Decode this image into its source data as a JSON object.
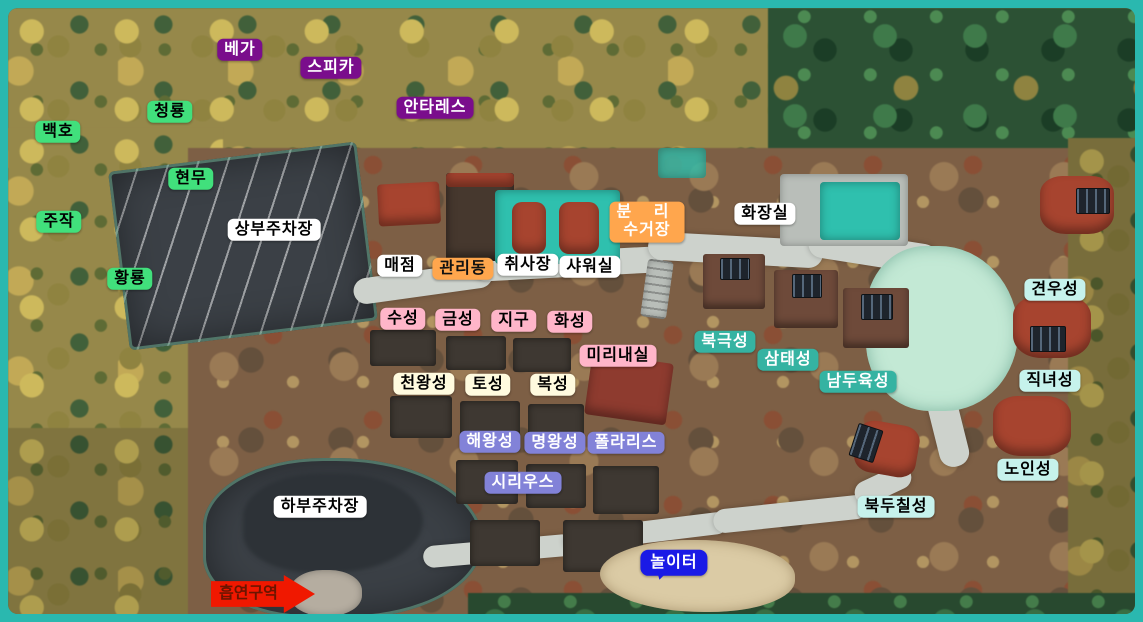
{
  "map_title": "campground aerial site map",
  "frame": {
    "border_color": "#2ab8af",
    "inner_line_color": "#0d837b"
  },
  "variants": {
    "purple": {
      "bg": "#7a0d8c",
      "fg": "#ffffff"
    },
    "green": {
      "bg": "#41e07c",
      "fg": "#000000"
    },
    "white": {
      "bg": "#ffffff",
      "fg": "#000000"
    },
    "orange-dark": {
      "bg": "#ffa64d",
      "fg": "#111111"
    },
    "orange-light": {
      "bg": "#ffa64d",
      "fg": "#ffffff"
    },
    "pink": {
      "bg": "#ffb5c9",
      "fg": "#000000"
    },
    "cream": {
      "bg": "#fffbdf",
      "fg": "#000000"
    },
    "periwinkle": {
      "bg": "#8282d8",
      "fg": "#ffffff"
    },
    "teal": {
      "bg": "#35b3a2",
      "fg": "#ffffff"
    },
    "pale-cyan": {
      "bg": "#c6f2ec",
      "fg": "#000000"
    },
    "blue": {
      "bg": "#1a1ae6",
      "fg": "#ffffff"
    },
    "red": {
      "bg": "#f01800",
      "fg": "#6b1500"
    }
  },
  "labels": [
    {
      "id": "vega",
      "text": "베가",
      "variant": "purple",
      "x": 232,
      "y": 42
    },
    {
      "id": "spica",
      "text": "스피카",
      "variant": "purple",
      "x": 323,
      "y": 60
    },
    {
      "id": "antares",
      "text": "안타레스",
      "variant": "purple",
      "x": 427,
      "y": 100
    },
    {
      "id": "cheongryong",
      "text": "청룡",
      "variant": "green",
      "x": 162,
      "y": 104
    },
    {
      "id": "baekho",
      "text": "백호",
      "variant": "green",
      "x": 50,
      "y": 124
    },
    {
      "id": "hyeonmu",
      "text": "현무",
      "variant": "green",
      "x": 183,
      "y": 171
    },
    {
      "id": "jujak",
      "text": "주작",
      "variant": "green",
      "x": 51,
      "y": 214
    },
    {
      "id": "hwangryong",
      "text": "황룡",
      "variant": "green",
      "x": 122,
      "y": 271
    },
    {
      "id": "upper-parking",
      "text": "상부주차장",
      "variant": "white",
      "x": 266,
      "y": 222
    },
    {
      "id": "store",
      "text": "매점",
      "variant": "white",
      "x": 392,
      "y": 258
    },
    {
      "id": "admin",
      "text": "관리동",
      "variant": "orange-dark",
      "x": 455,
      "y": 261
    },
    {
      "id": "cook-room",
      "text": "취사장",
      "variant": "white",
      "x": 520,
      "y": 257
    },
    {
      "id": "shower-room",
      "text": "샤워실",
      "variant": "white",
      "x": 582,
      "y": 259
    },
    {
      "id": "recycling",
      "lines": [
        "분 리",
        "수거장"
      ],
      "variant": "orange-light",
      "x": 639,
      "y": 214
    },
    {
      "id": "toilet",
      "text": "화장실",
      "variant": "white",
      "x": 757,
      "y": 206
    },
    {
      "id": "suseong",
      "text": "수성",
      "variant": "pink",
      "x": 395,
      "y": 311
    },
    {
      "id": "geumseong",
      "text": "금성",
      "variant": "pink",
      "x": 450,
      "y": 312
    },
    {
      "id": "jigu",
      "text": "지구",
      "variant": "pink",
      "x": 506,
      "y": 313
    },
    {
      "id": "hwaseong",
      "text": "화성",
      "variant": "pink",
      "x": 562,
      "y": 314
    },
    {
      "id": "mirinae-room",
      "text": "미리내실",
      "variant": "pink",
      "x": 610,
      "y": 348
    },
    {
      "id": "cheonwangseong",
      "text": "천왕성",
      "variant": "cream",
      "x": 416,
      "y": 376
    },
    {
      "id": "toseong",
      "text": "토성",
      "variant": "cream",
      "x": 480,
      "y": 377
    },
    {
      "id": "bokseong",
      "text": "복성",
      "variant": "cream",
      "x": 545,
      "y": 377
    },
    {
      "id": "haewangseong",
      "text": "해왕성",
      "variant": "periwinkle",
      "x": 482,
      "y": 434
    },
    {
      "id": "myeongwangseong",
      "text": "명왕성",
      "variant": "periwinkle",
      "x": 547,
      "y": 435
    },
    {
      "id": "polaris",
      "text": "폴라리스",
      "variant": "periwinkle",
      "x": 618,
      "y": 435
    },
    {
      "id": "sirius",
      "text": "시리우스",
      "variant": "periwinkle",
      "x": 515,
      "y": 475
    },
    {
      "id": "bukgeukseong",
      "text": "북극성",
      "variant": "teal",
      "x": 717,
      "y": 334
    },
    {
      "id": "samtaeseong",
      "text": "삼태성",
      "variant": "teal",
      "x": 780,
      "y": 352
    },
    {
      "id": "namduyukseong",
      "text": "남두육성",
      "variant": "teal",
      "x": 850,
      "y": 374
    },
    {
      "id": "gyeonuseong",
      "text": "견우성",
      "variant": "pale-cyan",
      "x": 1047,
      "y": 282
    },
    {
      "id": "jiknyeoseong",
      "text": "직녀성",
      "variant": "pale-cyan",
      "x": 1042,
      "y": 373
    },
    {
      "id": "noinseong",
      "text": "노인성",
      "variant": "pale-cyan",
      "x": 1020,
      "y": 462
    },
    {
      "id": "bukduchilseong",
      "text": "북두칠성",
      "variant": "pale-cyan",
      "x": 888,
      "y": 499
    },
    {
      "id": "lower-parking",
      "text": "하부주차장",
      "variant": "white",
      "x": 312,
      "y": 499
    },
    {
      "id": "playground",
      "text": "놀이터",
      "variant": "blue",
      "shape": "bubble",
      "x": 666,
      "y": 555
    },
    {
      "id": "smoking-area",
      "text": "흡연구역",
      "variant": "red",
      "shape": "arrow",
      "x": 255,
      "y": 586
    }
  ]
}
